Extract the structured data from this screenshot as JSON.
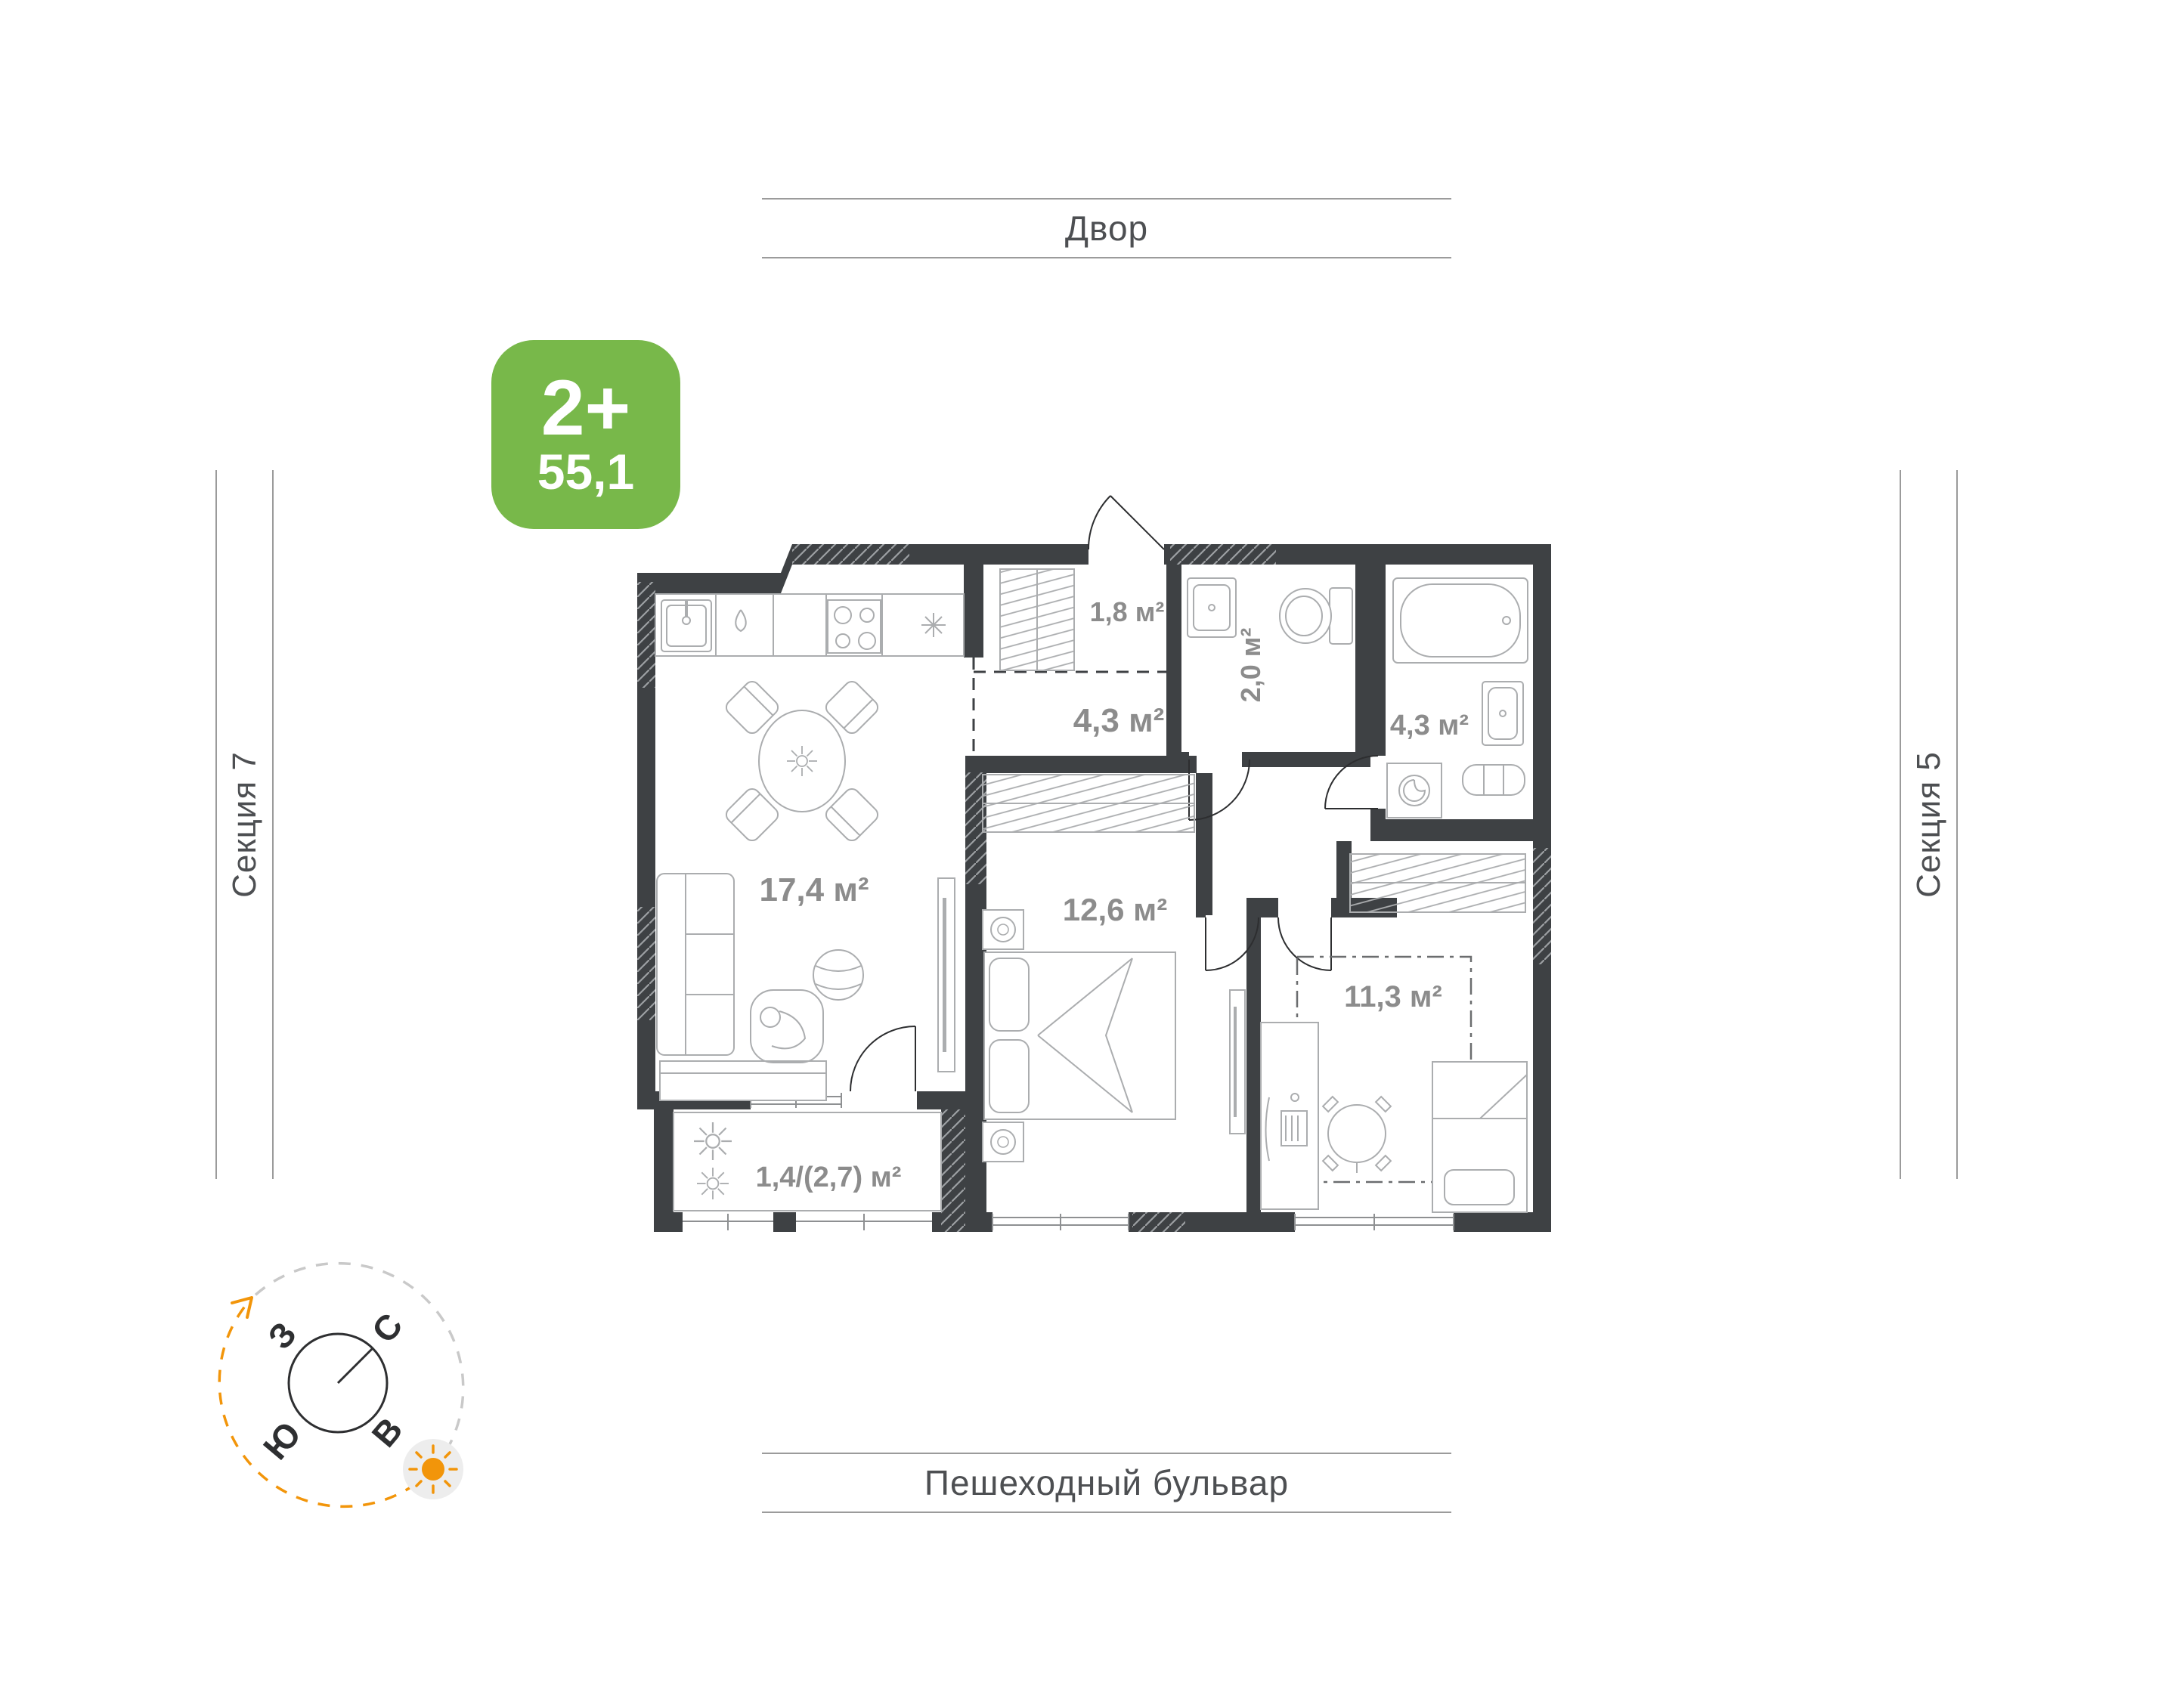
{
  "apartment_card": {
    "rooms_badge": "2+",
    "area_badge": "55,1"
  },
  "surroundings": {
    "top_street": "Двор",
    "bottom_street": "Пешеходный бульвар",
    "left_section": "Секция 7",
    "right_section": "Секция 5"
  },
  "floor_plan": {
    "rooms": [
      {
        "id": "kitchen-living",
        "area": "17,4 м²"
      },
      {
        "id": "hallway",
        "area": "4,3 м²"
      },
      {
        "id": "wardrobe-closet",
        "area": "1,8 м²"
      },
      {
        "id": "wc",
        "area": "2,0 м²"
      },
      {
        "id": "bathroom",
        "area": "4,3 м²"
      },
      {
        "id": "bedroom",
        "area": "12,6 м²"
      },
      {
        "id": "child-room",
        "area": "11,3 м²"
      },
      {
        "id": "balcony",
        "area": "1,4/(2,7) м²"
      }
    ]
  },
  "compass": {
    "north": "С",
    "east": "В",
    "south": "Ю",
    "west": "З"
  },
  "colors": {
    "badge_green": "#78B84A",
    "wall_dark": "#3E4144",
    "accent_orange": "#F2950A",
    "area_label_gray": "#8C8C8C",
    "guide_line_gray": "#9B9B9B"
  }
}
